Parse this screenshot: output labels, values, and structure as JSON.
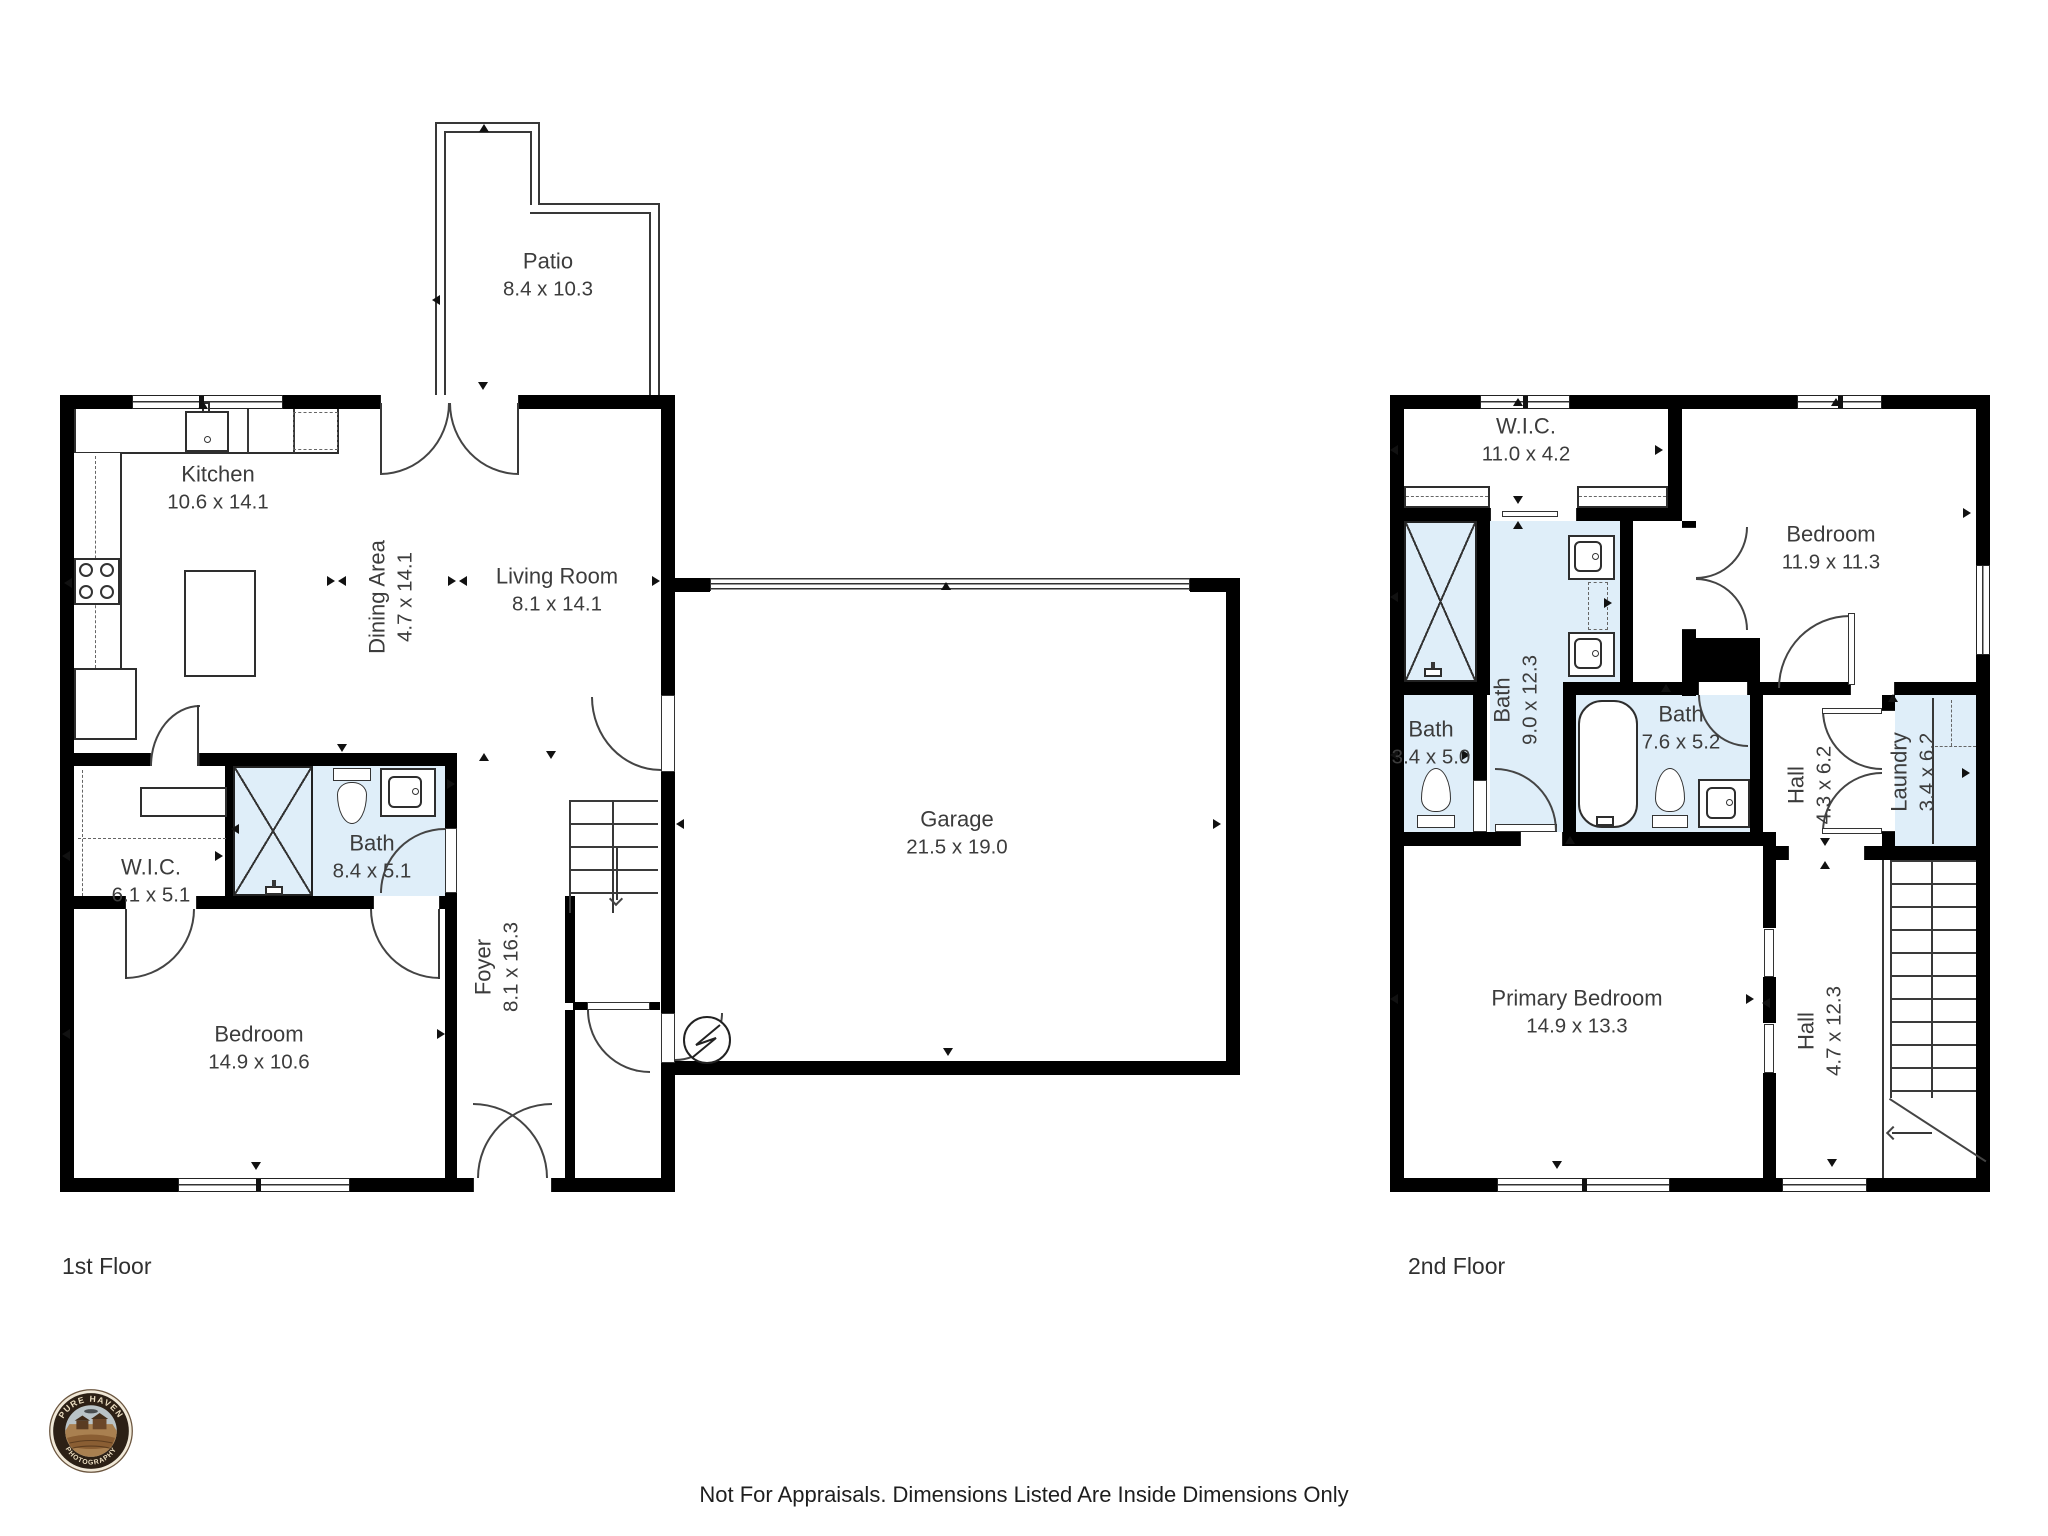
{
  "floors": [
    {
      "label": "1st Floor",
      "rooms": [
        {
          "name": "Patio",
          "dims": "8.4 x 10.3"
        },
        {
          "name": "Kitchen",
          "dims": "10.6 x 14.1"
        },
        {
          "name": "Dining Area",
          "dims": "4.7 x 14.1"
        },
        {
          "name": "Living Room",
          "dims": "8.1 x 14.1"
        },
        {
          "name": "Garage",
          "dims": "21.5 x 19.0"
        },
        {
          "name": "W.I.C.",
          "dims": "6.1 x 5.1"
        },
        {
          "name": "Bath",
          "dims": "8.4 x 5.1"
        },
        {
          "name": "Bedroom",
          "dims": "14.9 x 10.6"
        },
        {
          "name": "Foyer",
          "dims": "8.1 x 16.3"
        }
      ]
    },
    {
      "label": "2nd Floor",
      "rooms": [
        {
          "name": "W.I.C.",
          "dims": "11.0 x 4.2"
        },
        {
          "name": "Bedroom",
          "dims": "11.9 x 11.3"
        },
        {
          "name": "Bath",
          "dims": "9.0 x 12.3"
        },
        {
          "name": "Bath",
          "dims": "3.4 x 5.0"
        },
        {
          "name": "Bath",
          "dims": "7.6 x 5.2"
        },
        {
          "name": "Hall",
          "dims": "4.3 x 6.2"
        },
        {
          "name": "Laundry",
          "dims": "3.4 x 6.2"
        },
        {
          "name": "Primary Bedroom",
          "dims": "14.9 x 13.3"
        },
        {
          "name": "Hall",
          "dims": "4.7 x 12.3"
        }
      ]
    }
  ],
  "footer": {
    "disclaimer": "Not For Appraisals. Dimensions Listed Are Inside Dimensions Only"
  },
  "logo": {
    "brand_top": "PURE HAVEN",
    "brand_bottom": "PHOTOGRAPHY"
  },
  "colors": {
    "wall": "#000000",
    "bath_fill": "#dfeef9",
    "text": "#3c3c3c"
  }
}
